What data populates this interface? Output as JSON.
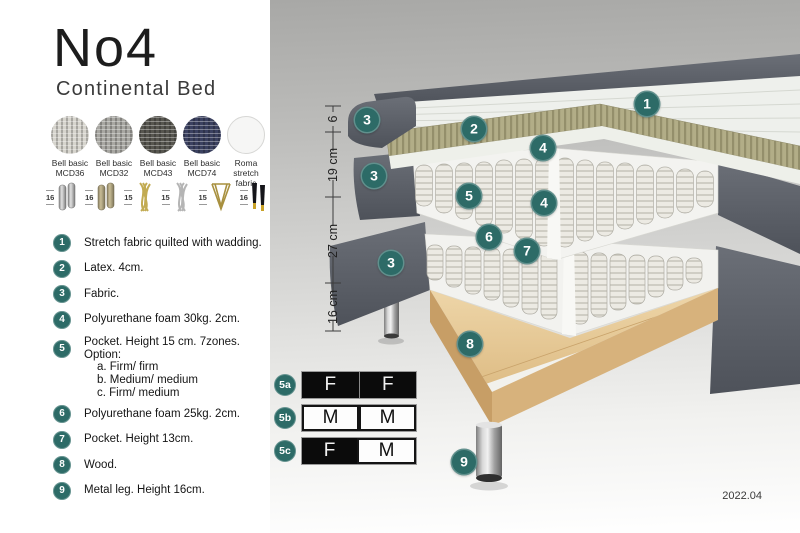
{
  "document": {
    "title": "No4",
    "subtitle": "Continental Bed",
    "version": "2022.04"
  },
  "fabric_swatches": [
    {
      "line1": "Bell basic",
      "line2": "MCD36",
      "color": "#d6d4cd"
    },
    {
      "line1": "Bell basic",
      "line2": "MCD32",
      "color": "#a8a7a2"
    },
    {
      "line1": "Bell basic",
      "line2": "MCD43",
      "color": "#57564f"
    },
    {
      "line1": "Bell basic",
      "line2": "MCD74",
      "color": "#3b4160"
    },
    {
      "line1": "Roma",
      "line2": "stretch fabric",
      "color": "#f6f6f5"
    }
  ],
  "leg_options": [
    {
      "height": "16",
      "type": "cylinder-silver"
    },
    {
      "height": "16",
      "type": "cylinder-brass"
    },
    {
      "height": "15",
      "type": "twisted-gold"
    },
    {
      "height": "15",
      "type": "twisted-silver"
    },
    {
      "height": "15",
      "type": "hairpin-gold"
    },
    {
      "height": "16",
      "type": "tapered-black-gold"
    }
  ],
  "layer_legend": [
    {
      "num": "1",
      "text": "Stretch fabric quilted with wadding."
    },
    {
      "num": "2",
      "text": "Latex. 4cm."
    },
    {
      "num": "3",
      "text": "Fabric."
    },
    {
      "num": "4",
      "text": "Polyurethane foam 30kg. 2cm."
    },
    {
      "num": "5",
      "text": "Pocket. Height 15 cm. 7zones. Option:",
      "options": [
        "a. Firm/ firm",
        "b. Medium/ medium",
        "c. Firm/ medium"
      ]
    },
    {
      "num": "6",
      "text": "Polyurethane foam 25kg. 2cm."
    },
    {
      "num": "7",
      "text": "Pocket. Height 13cm."
    },
    {
      "num": "8",
      "text": "Wood."
    },
    {
      "num": "9",
      "text": "Metal leg. Height 16cm."
    }
  ],
  "diagram": {
    "dimensions": [
      {
        "label": "6"
      },
      {
        "label": "19 cm"
      },
      {
        "label": "27 cm"
      },
      {
        "label": "16 cm"
      }
    ],
    "markers": [
      {
        "num": "1"
      },
      {
        "num": "2"
      },
      {
        "num": "3"
      },
      {
        "num": "4"
      },
      {
        "num": "3"
      },
      {
        "num": "5"
      },
      {
        "num": "4"
      },
      {
        "num": "6"
      },
      {
        "num": "7"
      },
      {
        "num": "3"
      },
      {
        "num": "8"
      },
      {
        "num": "9"
      }
    ]
  },
  "firmness": {
    "rows": [
      {
        "label": "5a",
        "cells": [
          {
            "letter": "F",
            "variant": "dark"
          },
          {
            "letter": "F",
            "variant": "dark"
          }
        ]
      },
      {
        "label": "5b",
        "cells": [
          {
            "letter": "M",
            "variant": "light"
          },
          {
            "letter": "M",
            "variant": "light"
          }
        ]
      },
      {
        "label": "5c",
        "cells": [
          {
            "letter": "F",
            "variant": "dark"
          },
          {
            "letter": "M",
            "variant": "light"
          }
        ]
      }
    ]
  },
  "colors": {
    "accent_teal": "#2d6b67",
    "fabric_dark_gray": "#575b63",
    "latex_olive": "#b2ad87",
    "wood": "#e7cda0",
    "black_cell": "#0b0b0b"
  }
}
